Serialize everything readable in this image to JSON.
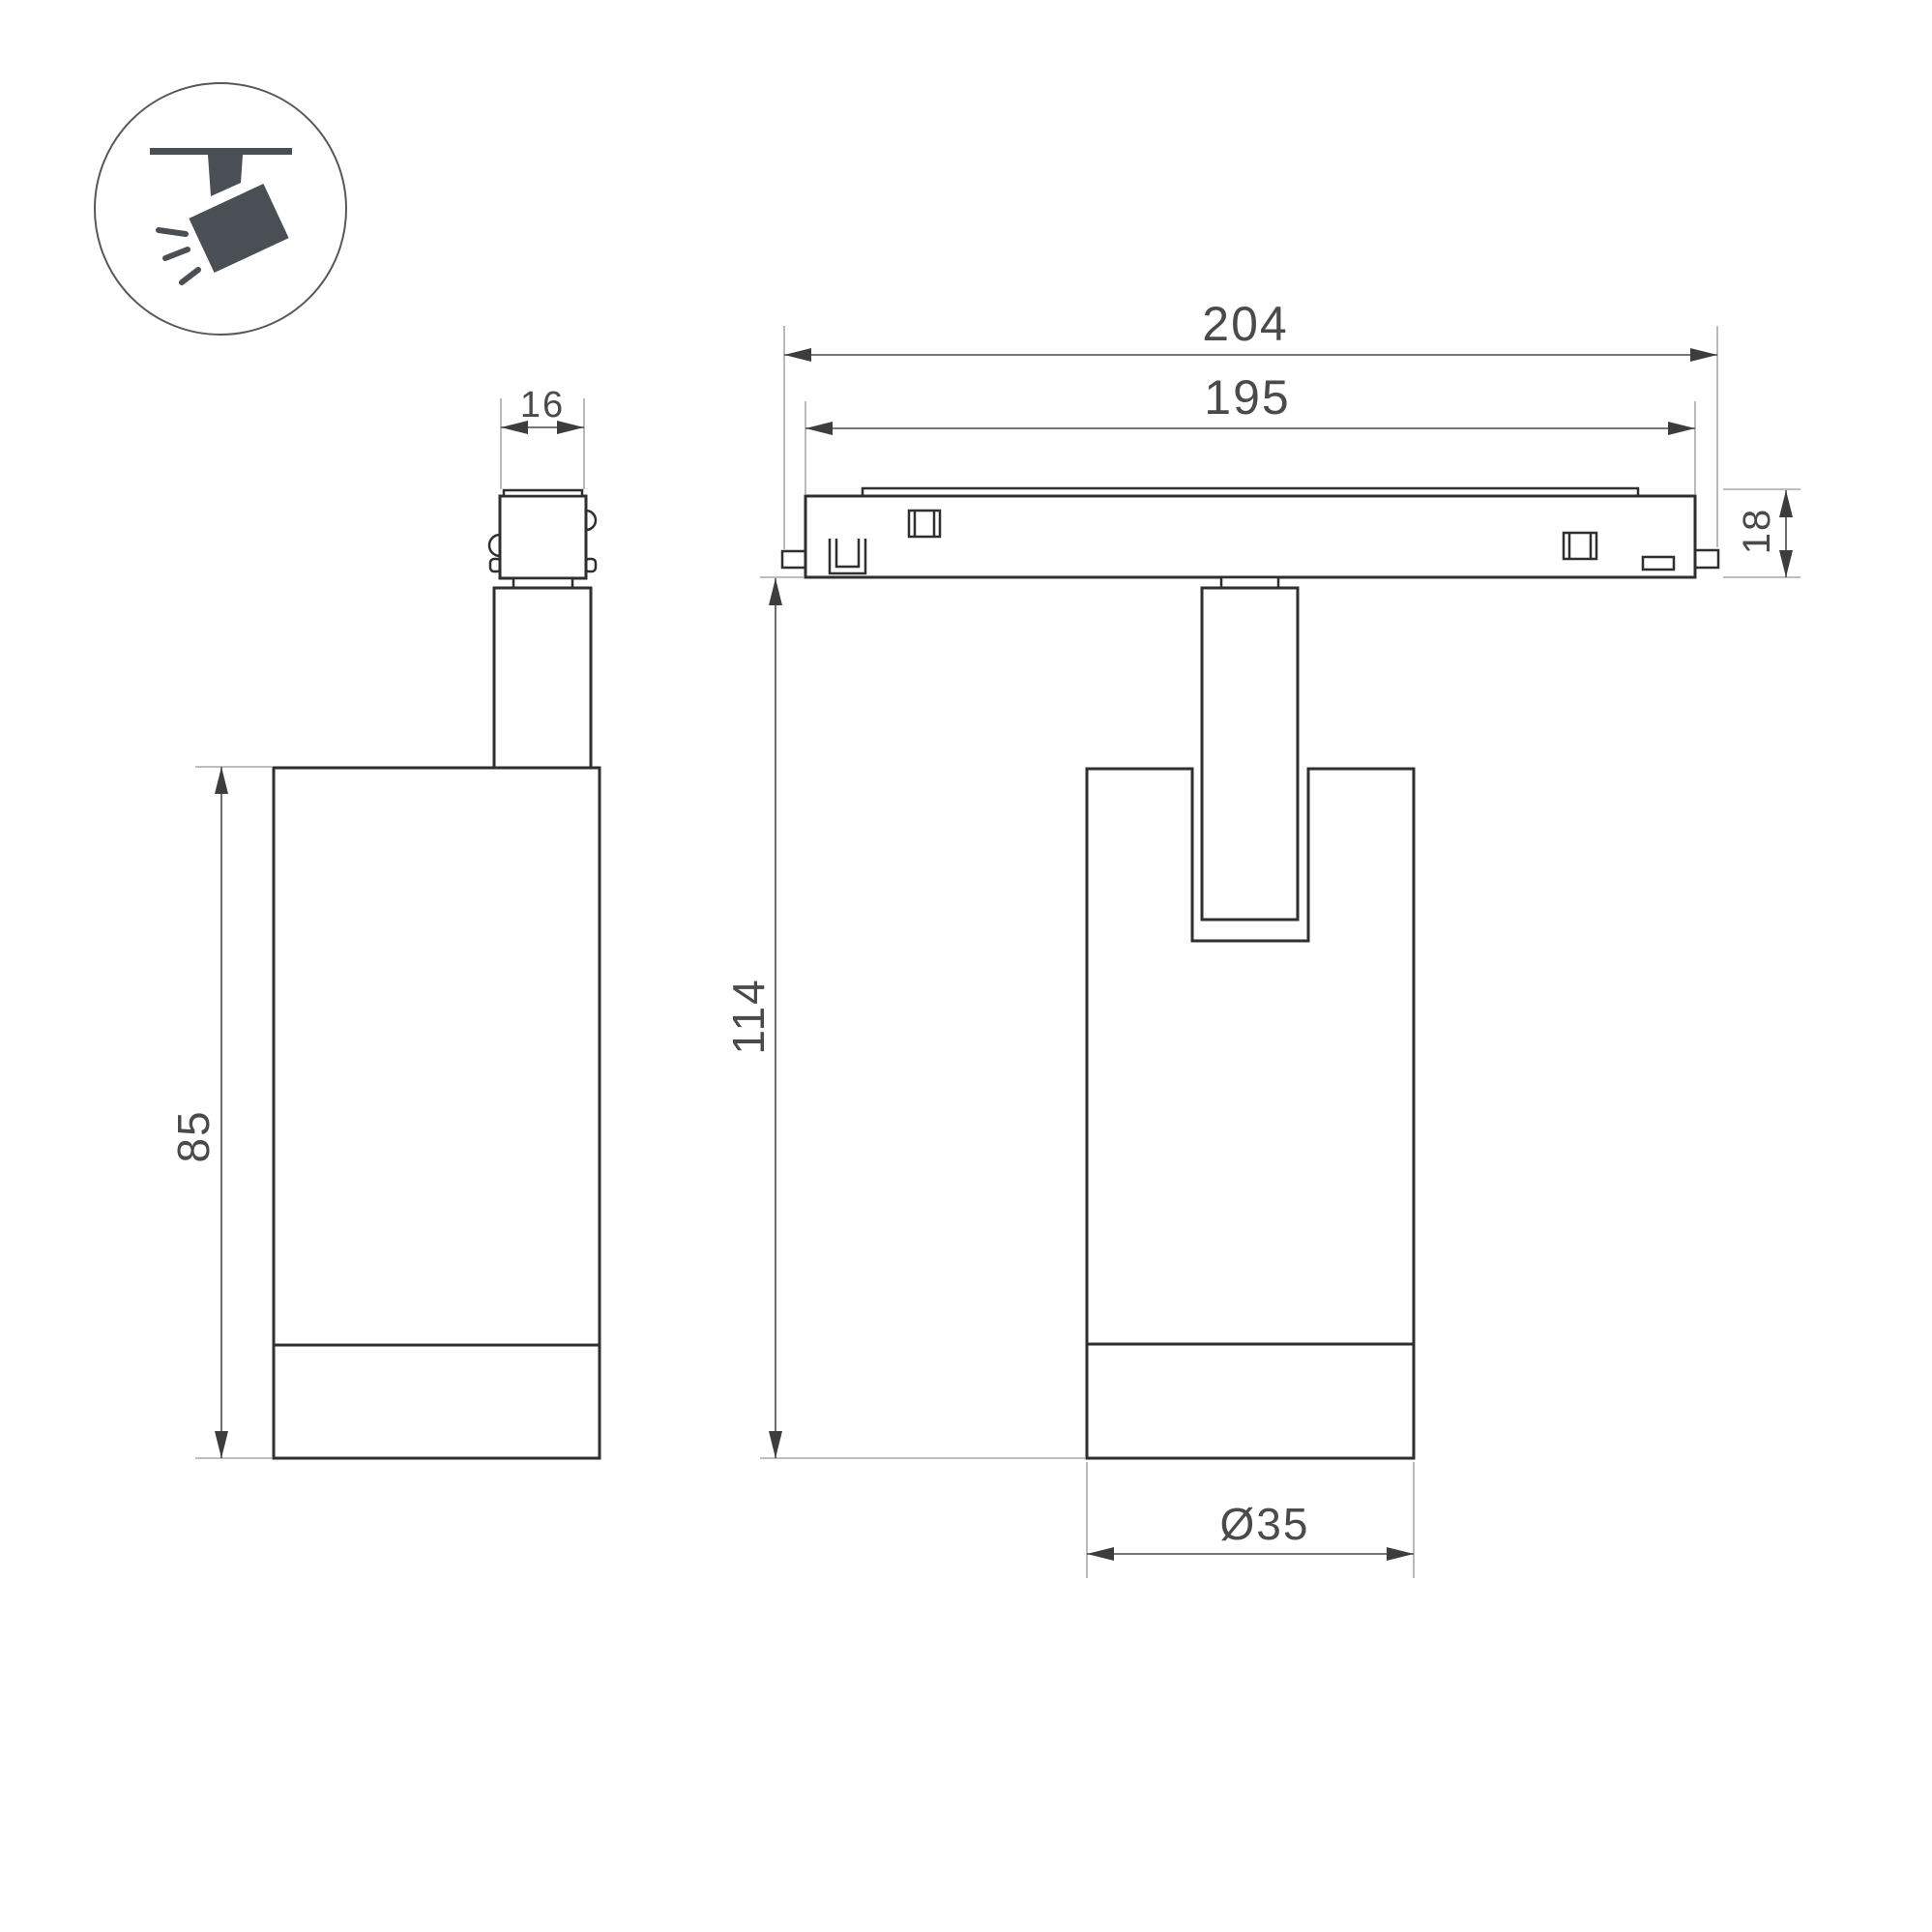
{
  "drawing": {
    "type": "technical-dimension-drawing",
    "subject": "magnetic-track-spotlight",
    "icon": "ceiling-track-spotlight-icon",
    "colors": {
      "background": "#ffffff",
      "outline": "#2f2f2f",
      "dimension": "#4a4a4a",
      "extension": "#a8a8a8",
      "icon_fill": "#4a4f55"
    },
    "side_view": {
      "connector_width": "16",
      "body_height": "85"
    },
    "front_view": {
      "overall_length": "204",
      "track_length": "195",
      "track_height": "18",
      "overall_height": "114",
      "body_diameter": "Ø35"
    }
  }
}
